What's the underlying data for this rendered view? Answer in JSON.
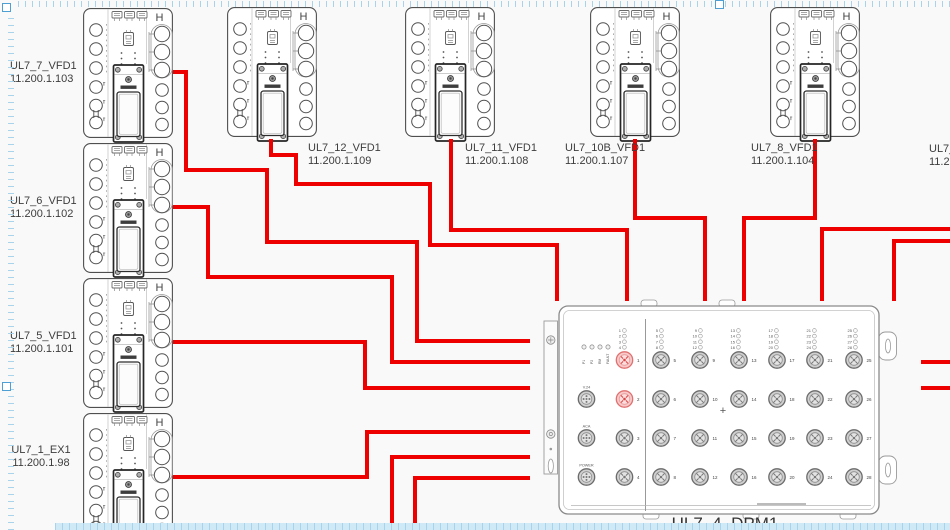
{
  "colors": {
    "wire": "#ee0000",
    "device_outline": "#4f4f4f",
    "ruler_tick": "#a9d3ea",
    "ruler_strip": "#cfe9f6",
    "handle": "#4e9fd4",
    "label_text": "#3d3d3d"
  },
  "vfd": {
    "h_glyph": "H"
  },
  "devices": [
    {
      "name": "UL7_7_VFD1",
      "ip": "11.200.1.103",
      "x": 83,
      "y": 8,
      "label_x": 10,
      "label_y": 60,
      "align": "center"
    },
    {
      "name": "UL7_6_VFD1",
      "ip": "11.200.1.102",
      "x": 83,
      "y": 143,
      "label_x": 10,
      "label_y": 195,
      "align": "center"
    },
    {
      "name": "UL7_5_VFD1",
      "ip": "11.200.1.101",
      "x": 83,
      "y": 278,
      "label_x": 10,
      "label_y": 330,
      "align": "center"
    },
    {
      "name": "UL7_1_EX1",
      "ip": "11.200.1.98",
      "x": 83,
      "y": 413,
      "label_x": 10,
      "label_y": 444,
      "align": "center"
    },
    {
      "name": "UL7_12_VFD1",
      "ip": "11.200.1.109",
      "x": 227,
      "y": 7,
      "label_x": 308,
      "label_y": 142
    },
    {
      "name": "UL7_11_VFD1",
      "ip": "11.200.1.108",
      "x": 405,
      "y": 7,
      "label_x": 465,
      "label_y": 142
    },
    {
      "name": "UL7_10B_VFD1",
      "ip": "11.200.1.107",
      "x": 590,
      "y": 7,
      "label_x": 565,
      "label_y": 142
    },
    {
      "name": "UL7_8_VFD1",
      "ip": "11.200.1.104",
      "x": 770,
      "y": 7,
      "label_x": 751,
      "label_y": 142
    },
    {
      "name": "UL7_",
      "ip": "11.2",
      "label_x": 929,
      "label_y": 143,
      "offscreen": true
    }
  ],
  "dpm": {
    "label": "UL7_4_DPM1",
    "status_leds": [
      "P1",
      "P2",
      "RM",
      "FAULT"
    ],
    "side_ports": [
      {
        "label": "V.24",
        "y": 399
      },
      {
        "label": "ACA",
        "y": 438
      },
      {
        "label": "POWER",
        "y": 477
      }
    ],
    "left_ports": [
      {
        "num": "1",
        "y": 360,
        "red": true
      },
      {
        "num": "2",
        "y": 399,
        "red": true
      },
      {
        "num": "3",
        "y": 438
      },
      {
        "num": "4",
        "y": 477
      }
    ],
    "led_blocks": [
      {
        "x": 621,
        "nums": [
          "1",
          "2",
          "3",
          "4"
        ]
      },
      {
        "x": 658,
        "nums": [
          "5",
          "6",
          "7",
          "8"
        ]
      },
      {
        "x": 697,
        "nums": [
          "9",
          "10",
          "11",
          "12"
        ]
      },
      {
        "x": 735,
        "nums": [
          "13",
          "14",
          "15",
          "16"
        ]
      },
      {
        "x": 773,
        "nums": [
          "17",
          "18",
          "19",
          "20"
        ]
      },
      {
        "x": 811,
        "nums": [
          "21",
          "22",
          "23",
          "24"
        ]
      },
      {
        "x": 852,
        "nums": [
          "25",
          "26",
          "27",
          "28"
        ]
      }
    ],
    "grid_columns": [
      {
        "x": 661,
        "nums": [
          "5",
          "6",
          "7",
          "8"
        ]
      },
      {
        "x": 700,
        "nums": [
          "9",
          "10",
          "11",
          "12"
        ]
      },
      {
        "x": 739,
        "nums": [
          "13",
          "14",
          "15",
          "16"
        ]
      },
      {
        "x": 777,
        "nums": [
          "17",
          "18",
          "19",
          "20"
        ]
      },
      {
        "x": 815,
        "nums": [
          "21",
          "22",
          "23",
          "24"
        ]
      },
      {
        "x": 854,
        "nums": [
          "25",
          "26",
          "27",
          "28"
        ]
      }
    ],
    "row_ys": [
      360,
      399,
      438,
      477
    ],
    "plus_marker": "+"
  },
  "wires": [
    [
      [
        173,
        72
      ],
      [
        186,
        72
      ],
      [
        186,
        170
      ],
      [
        267,
        170
      ],
      [
        267,
        242
      ],
      [
        417,
        242
      ],
      [
        417,
        341
      ],
      [
        530,
        341
      ]
    ],
    [
      [
        271,
        139
      ],
      [
        271,
        155
      ],
      [
        296,
        155
      ],
      [
        296,
        184
      ],
      [
        430,
        184
      ],
      [
        430,
        245
      ],
      [
        557,
        245
      ],
      [
        557,
        301
      ]
    ],
    [
      [
        173,
        207
      ],
      [
        208,
        207
      ],
      [
        208,
        277
      ],
      [
        392,
        277
      ],
      [
        392,
        362
      ],
      [
        530,
        362
      ]
    ],
    [
      [
        173,
        342
      ],
      [
        365,
        342
      ],
      [
        365,
        388
      ],
      [
        530,
        388
      ]
    ],
    [
      [
        451,
        139
      ],
      [
        451,
        230
      ],
      [
        627,
        230
      ],
      [
        627,
        301
      ]
    ],
    [
      [
        635,
        139
      ],
      [
        635,
        218
      ],
      [
        705,
        218
      ],
      [
        705,
        301
      ]
    ],
    [
      [
        815,
        139
      ],
      [
        815,
        218
      ],
      [
        744,
        218
      ],
      [
        744,
        301
      ]
    ],
    [
      [
        950,
        229
      ],
      [
        822,
        229
      ],
      [
        822,
        301
      ]
    ],
    [
      [
        950,
        241
      ],
      [
        894,
        241
      ],
      [
        894,
        301
      ]
    ],
    [
      [
        173,
        477
      ],
      [
        367,
        477
      ],
      [
        367,
        432
      ],
      [
        530,
        432
      ]
    ],
    [
      [
        392,
        531
      ],
      [
        392,
        457
      ],
      [
        530,
        457
      ]
    ],
    [
      [
        415,
        531
      ],
      [
        415,
        478
      ],
      [
        530,
        478
      ]
    ],
    [
      [
        921,
        362
      ],
      [
        950,
        362
      ]
    ],
    [
      [
        921,
        388
      ],
      [
        950,
        388
      ]
    ]
  ],
  "handles": [
    [
      2,
      3
    ],
    [
      715,
      0
    ],
    [
      2,
      382
    ]
  ]
}
